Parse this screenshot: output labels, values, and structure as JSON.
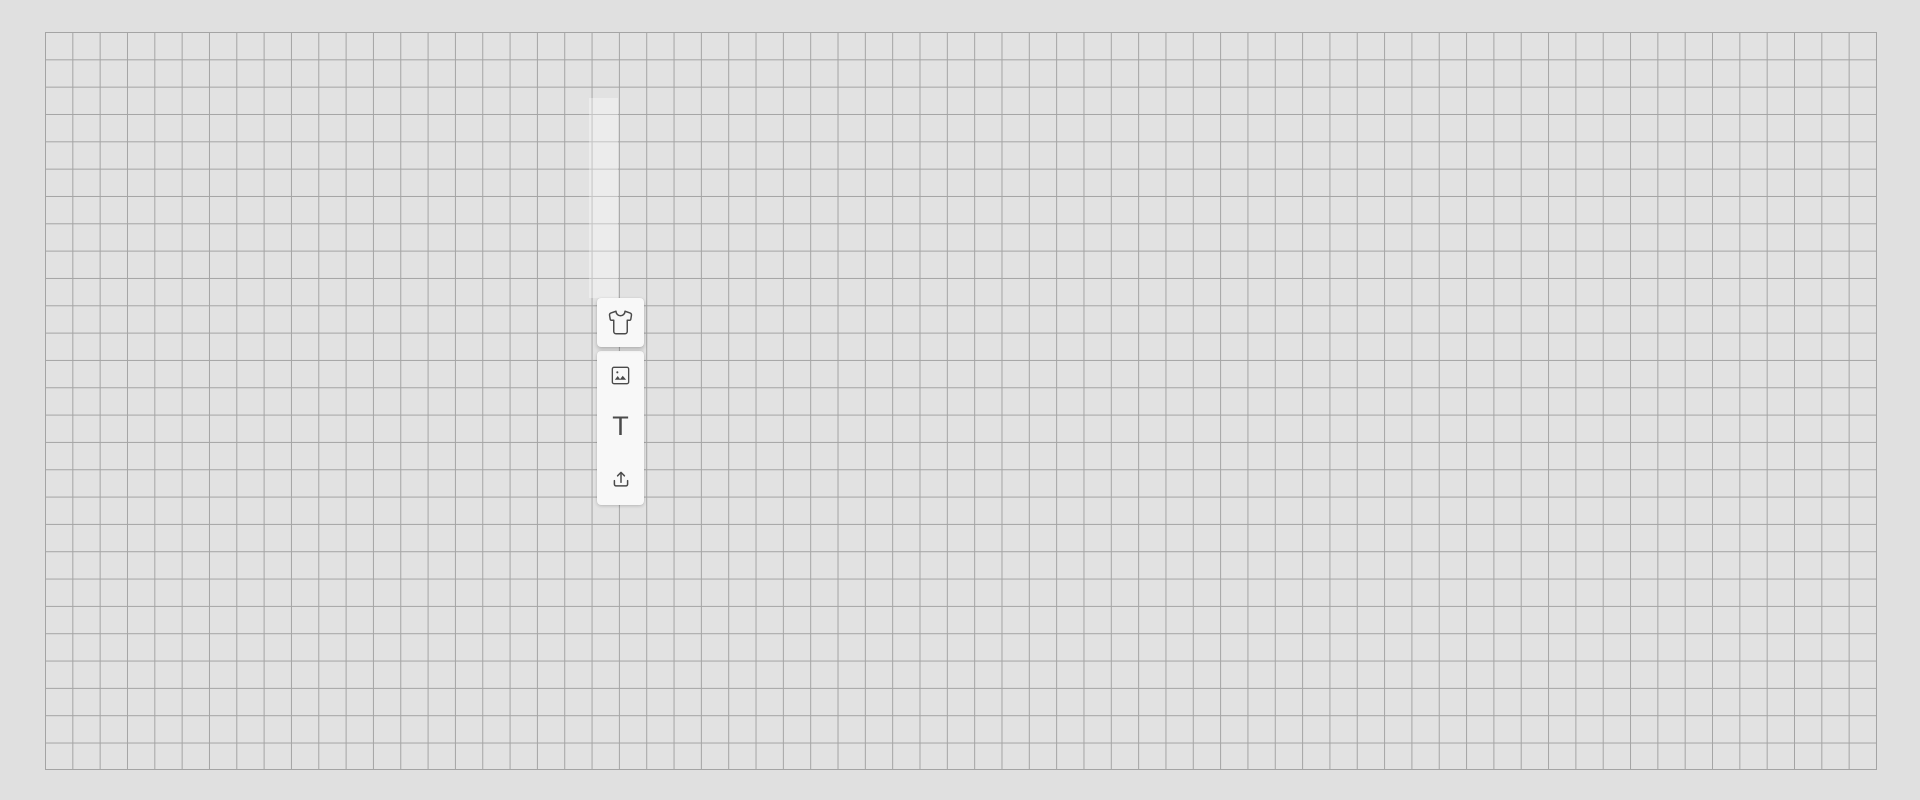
{
  "window": {
    "width_px": 1920,
    "height_px": 800,
    "background_color": "#e0e0e0"
  },
  "canvas": {
    "grid": {
      "left_px": 45,
      "top_px": 32,
      "width_px": 1832,
      "height_px": 738,
      "cell_size_px": 27.3,
      "columns": 67,
      "rows": 27,
      "line_color": "#a4a4a4",
      "fill_color": "#e2e2e2"
    },
    "guide_strip_color": "rgba(255,255,255,0.35)"
  },
  "toolbar": {
    "background_color": "#f8f8f8",
    "icon_color": "#4a4a4a",
    "buttons": [
      {
        "name": "product-tool",
        "icon": "tshirt-icon",
        "active": true
      },
      {
        "name": "image-tool",
        "icon": "image-icon",
        "active": false
      },
      {
        "name": "text-tool",
        "icon": "text-icon",
        "glyph": "T",
        "active": false
      },
      {
        "name": "upload-tool",
        "icon": "upload-icon",
        "active": false
      }
    ]
  }
}
